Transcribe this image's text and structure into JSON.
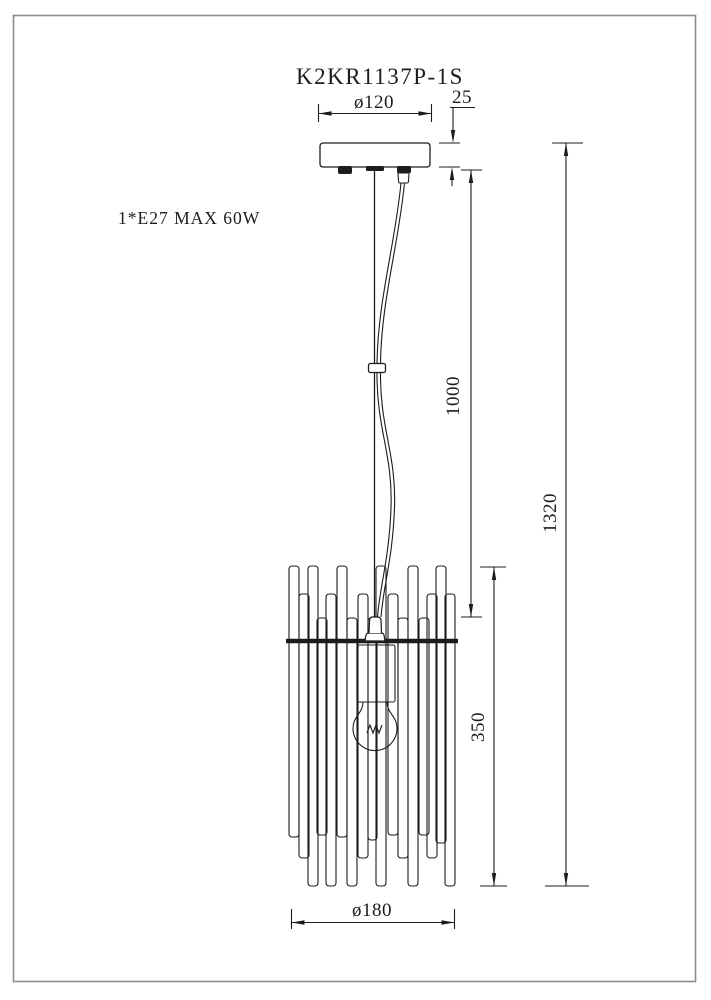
{
  "page": {
    "background_color": "#ffffff",
    "line_color": "#1c1c1c",
    "frame_color": "#8c8c8c"
  },
  "drawing": {
    "model_number": "K2KR1137P-1S",
    "lamp_spec": "1*E27 MAX 60W",
    "dimensions": {
      "canopy_diameter": "ø120",
      "canopy_height": "25",
      "suspension_length": "1000",
      "total_height": "1320",
      "shade_height": "350",
      "shade_diameter": "ø180"
    }
  }
}
